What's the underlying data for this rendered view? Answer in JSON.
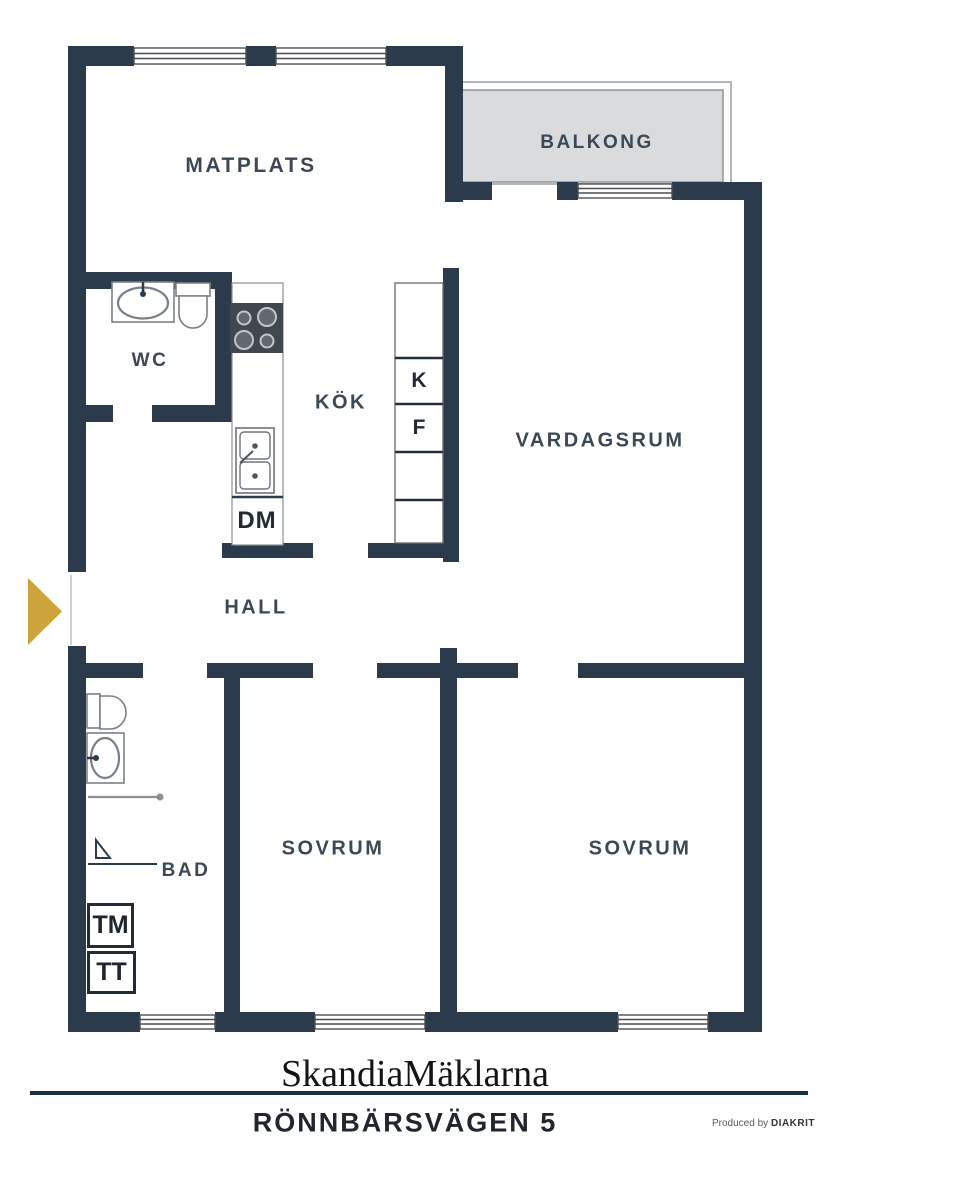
{
  "document": {
    "type": "apartment floor plan"
  },
  "plan": {
    "rooms": {
      "matplats": "MATPLATS",
      "balkong": "BALKONG",
      "wc": "WC",
      "kok": "KÖK",
      "vardagsrum": "VARDAGSRUM",
      "hall": "HALL",
      "bad": "BAD",
      "sovrum1": "SOVRUM",
      "sovrum2": "SOVRUM"
    },
    "appliances": {
      "fridge": "K",
      "freezer": "F",
      "dishwasher": "DM",
      "washing_machine": "TM",
      "tumble_dryer": "TT"
    },
    "colors": {
      "wall": "#2c3b4c",
      "balcony_fill": "#d9dcdc",
      "entrance_arrow": "#cda33c",
      "label_text": "#3c4854"
    }
  },
  "footer": {
    "brand": "SkandiaMäklarna",
    "address": "RÖNNBÄRSVÄGEN 5",
    "produced_prefix": "Produced by",
    "producer": "DIAKRIT"
  }
}
